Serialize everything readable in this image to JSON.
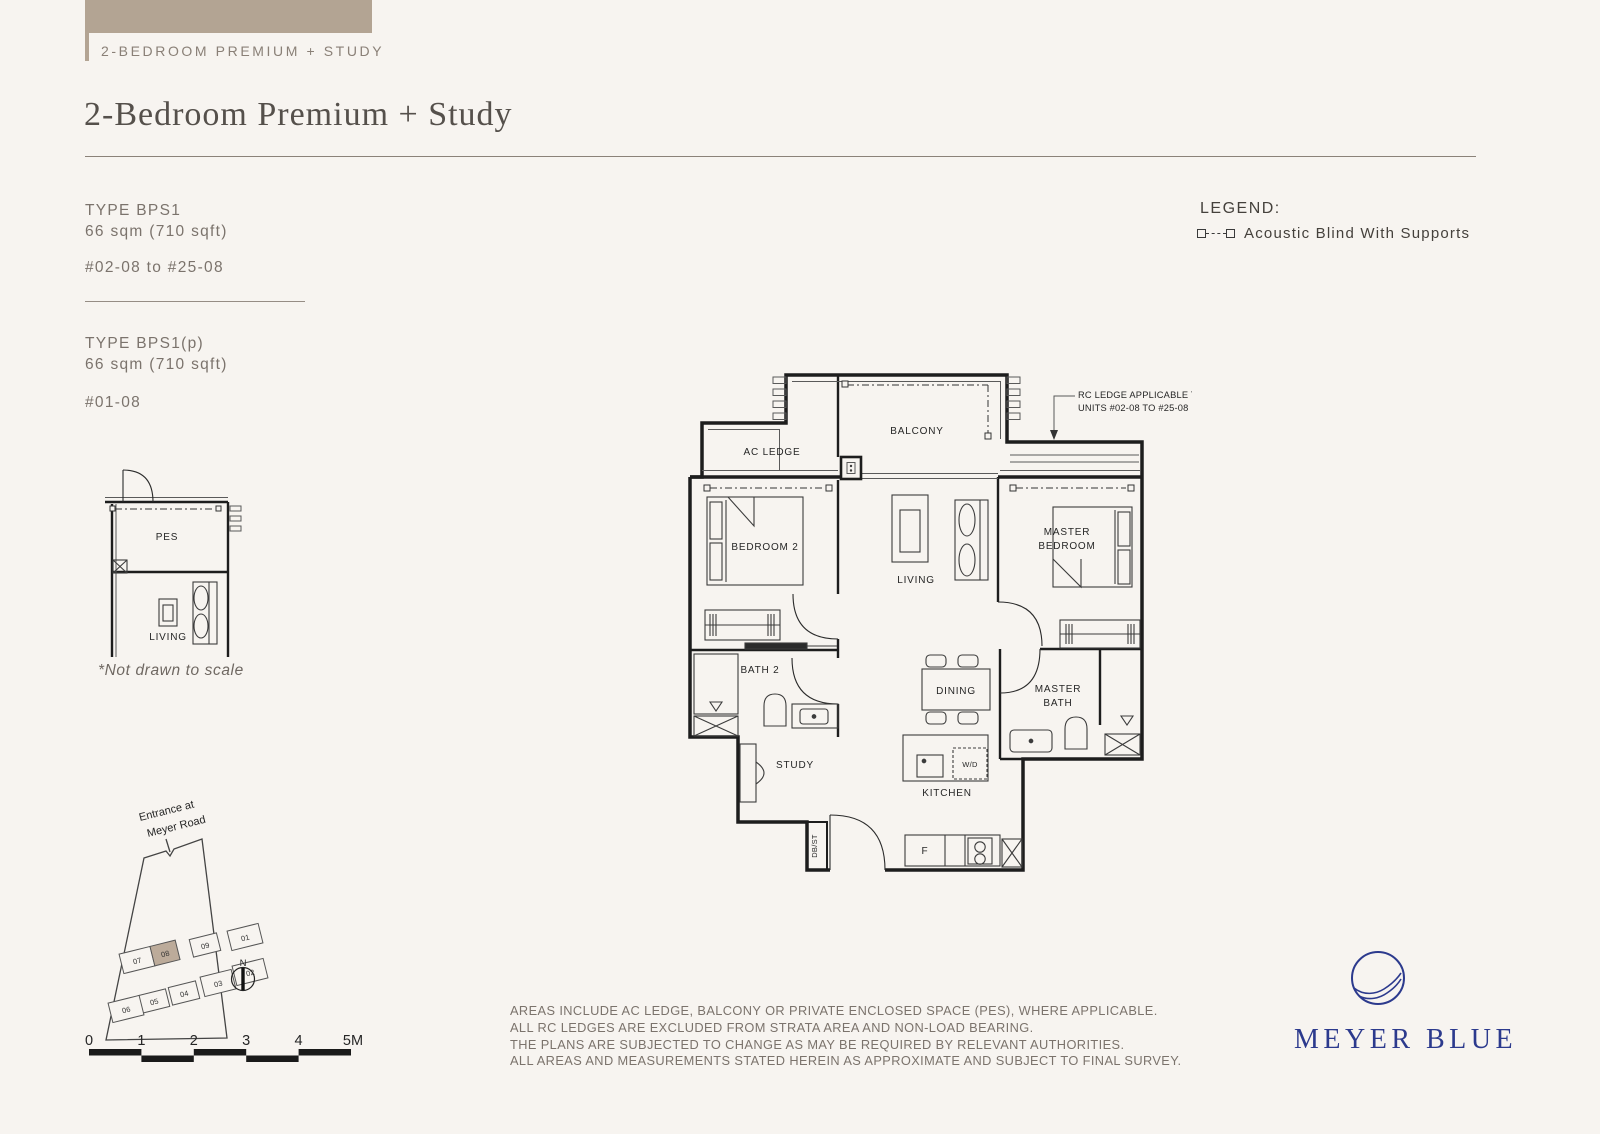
{
  "header": {
    "tab_label": "2-BEDROOM PREMIUM + STUDY",
    "title": "2-Bedroom Premium + Study"
  },
  "types": [
    {
      "name": "TYPE BPS1",
      "area": "66 sqm (710 sqft)",
      "units": "#02-08 to #25-08"
    },
    {
      "name": "TYPE BPS1(p)",
      "area": "66 sqm (710 sqft)",
      "units": "#01-08"
    }
  ],
  "legend": {
    "title": "LEGEND:",
    "item": "Acoustic Blind With Supports"
  },
  "plan": {
    "labels": {
      "ac_ledge": "AC LEDGE",
      "balcony": "BALCONY",
      "bedroom2": "BEDROOM 2",
      "living": "LIVING",
      "master1": "MASTER",
      "master2": "BEDROOM",
      "bath2": "BATH 2",
      "dining": "DINING",
      "mbath1": "MASTER",
      "mbath2": "BATH",
      "study": "STUDY",
      "kitchen": "KITCHEN",
      "wd": "W/D",
      "dbst": "DB/ST",
      "fridge": "F"
    },
    "annotation": {
      "line1": "RC LEDGE APPLICABLE TO",
      "line2": "UNITS #02-08 TO #25-08"
    }
  },
  "inset": {
    "pes": "PES",
    "living": "LIVING",
    "note": "*Not drawn to scale"
  },
  "site": {
    "entrance1": "Entrance at",
    "entrance2": "Meyer Road",
    "north": "N",
    "units": [
      "01",
      "02",
      "03",
      "04",
      "05",
      "06",
      "07",
      "08",
      "09"
    ]
  },
  "scale": {
    "labels": [
      "0",
      "1",
      "2",
      "3",
      "4",
      "5M"
    ]
  },
  "disclaimer": {
    "lines": [
      "AREAS INCLUDE AC LEDGE, BALCONY OR PRIVATE ENCLOSED SPACE (PES), WHERE APPLICABLE.",
      "ALL RC LEDGES ARE EXCLUDED FROM STRATA AREA AND NON-LOAD BEARING.",
      "THE PLANS ARE SUBJECTED TO CHANGE AS MAY BE REQUIRED BY RELEVANT AUTHORITIES.",
      "ALL AREAS AND MEASUREMENTS STATED HEREIN AS APPROXIMATE AND SUBJECT TO FINAL SURVEY."
    ]
  },
  "logo": {
    "name": "MEYER BLUE",
    "color": "#2c3a8d"
  },
  "colors": {
    "accent": "#b3a493",
    "background": "#f7f4f0",
    "highlight_unit": "#bcab9a"
  }
}
